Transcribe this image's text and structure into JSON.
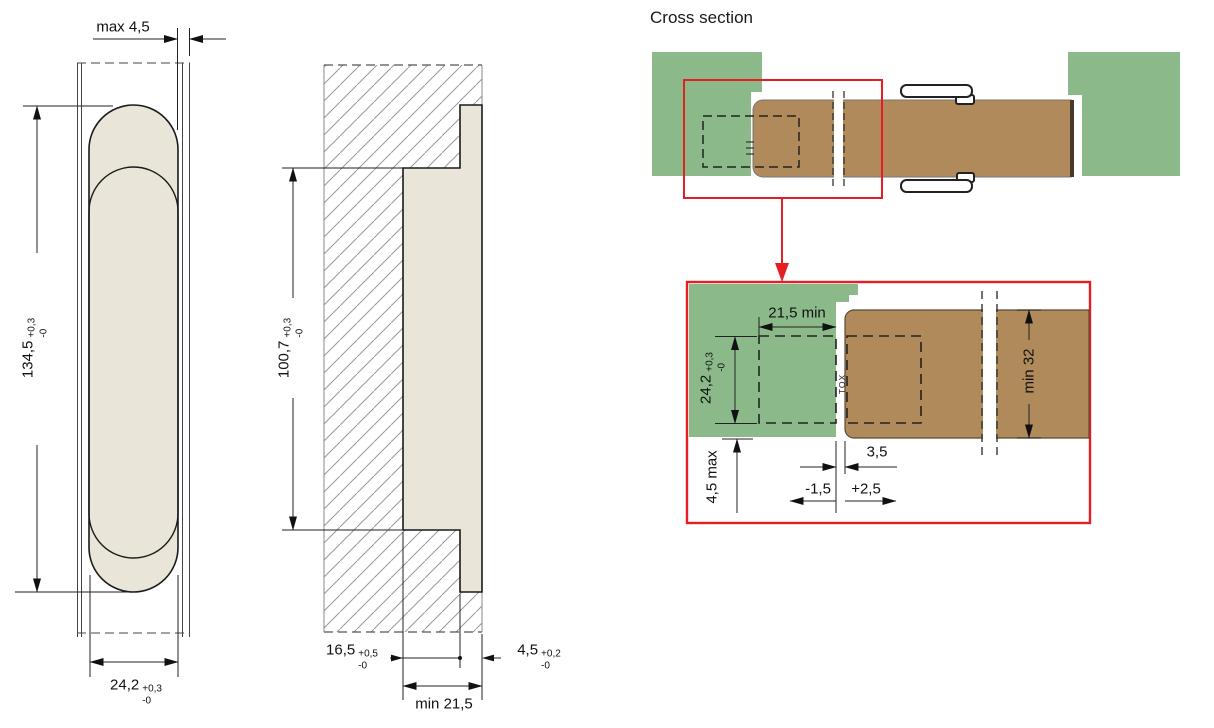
{
  "cross_section": {
    "title": "Cross section"
  },
  "front_view": {
    "dim_gap_top": "max 4,5",
    "dim_height": {
      "value": "134,5",
      "tol_plus": "+0,3",
      "tol_minus": "-0"
    },
    "dim_width": {
      "value": "24,2",
      "tol_plus": "+0,3",
      "tol_minus": "-0"
    }
  },
  "side_view": {
    "dim_height": {
      "value": "100,7",
      "tol_plus": "+0,3",
      "tol_minus": "-0"
    },
    "dim_body_depth": {
      "value": "16,5",
      "tol_plus": "+0,5",
      "tol_minus": "-0"
    },
    "dim_flange_depth": {
      "value": "4,5",
      "tol_plus": "+0,2",
      "tol_minus": "-0"
    },
    "dim_min_depth": "min 21,5"
  },
  "detail_view": {
    "dim_frame_depth": "21,5 min",
    "dim_cutout_width": {
      "value": "24,2",
      "tol_plus": "+0,3",
      "tol_minus": "-0"
    },
    "dim_face_offset": "4,5 max",
    "dim_gap": "3,5",
    "dim_gap_minus": "-1,5",
    "dim_gap_plus": "+2,5",
    "dim_door_thickness": "min 32",
    "knuckle_marking": "TOX"
  },
  "colors": {
    "frame_green": "#8cb98a",
    "door_brown": "#b08a5a",
    "hinge_beige": "#e9e5d9",
    "highlight_red": "#e41e23"
  }
}
